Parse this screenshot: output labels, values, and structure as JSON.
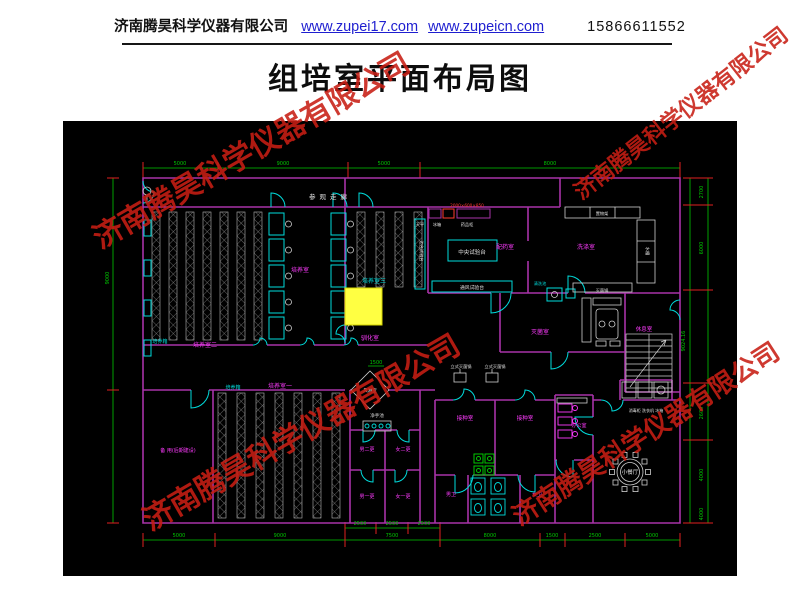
{
  "header": {
    "company": "济南腾昊科学仪器有限公司",
    "link1": "www.zupei17.com",
    "link2": "www.zupeicn.com",
    "phone": "15866611552"
  },
  "title": "组培室平面布局图",
  "watermark": {
    "text": "济南腾昊科学仪器有限公司",
    "color": "#c81e14",
    "instances": [
      {
        "x": 70,
        "y": 126,
        "size": 30,
        "rotate": -30
      },
      {
        "x": 548,
        "y": 96,
        "size": 22,
        "rotate": -38
      },
      {
        "x": 120,
        "y": 408,
        "size": 30,
        "rotate": -30
      },
      {
        "x": 489,
        "y": 414,
        "size": 26,
        "rotate": -33
      }
    ]
  },
  "plan": {
    "colors": {
      "background": "#000000",
      "wall": "#a833a8",
      "label_magenta": "#ff3bff",
      "cyan": "#00dcdc",
      "dim_green": "#00c800",
      "tick_red": "#e02020",
      "white": "#e0e0e0",
      "rack": "#b5b5b5",
      "highlight_yellow": "#ffff42",
      "bench_red": "#ff3b30",
      "green_fixture": "#00c800"
    },
    "room_labels": [
      {
        "t": "参观走廊",
        "x": 267,
        "y": 78,
        "c": "#e0e0e0",
        "s": 6.5,
        "sp": 4
      },
      {
        "t": "培养室",
        "x": 237,
        "y": 151,
        "c": "#ff3bff",
        "s": 6
      },
      {
        "t": "培养室二",
        "x": 142,
        "y": 226,
        "c": "#ff3bff",
        "s": 6
      },
      {
        "t": "培养箱",
        "x": 97,
        "y": 222,
        "c": "#00dcdc",
        "s": 5
      },
      {
        "t": "培养室三",
        "x": 311,
        "y": 162,
        "c": "#00dcdc",
        "s": 6
      },
      {
        "t": "驯化室",
        "x": 307,
        "y": 219,
        "c": "#ff3bff",
        "s": 6
      },
      {
        "t": "培养室一",
        "x": 217,
        "y": 267,
        "c": "#ff3bff",
        "s": 6
      },
      {
        "t": "培养箱",
        "x": 170,
        "y": 268,
        "c": "#00dcdc",
        "s": 5
      },
      {
        "t": "备 用(后期建设)",
        "x": 115,
        "y": 331,
        "c": "#ff3bff",
        "s": 5
      },
      {
        "t": "配药室",
        "x": 442,
        "y": 128,
        "c": "#ff3bff",
        "s": 6
      },
      {
        "t": "洗涤室",
        "x": 523,
        "y": 128,
        "c": "#ff3bff",
        "s": 6
      },
      {
        "t": "灭菌室",
        "x": 477,
        "y": 213,
        "c": "#ff3bff",
        "s": 6
      },
      {
        "t": "休息室",
        "x": 581,
        "y": 210,
        "c": "#ff3bff",
        "s": 5.5
      },
      {
        "t": "办公室",
        "x": 516,
        "y": 306,
        "c": "#ff3bff",
        "s": 5
      },
      {
        "t": "接种室",
        "x": 402,
        "y": 299,
        "c": "#ff3bff",
        "s": 5.5
      },
      {
        "t": "接种室",
        "x": 462,
        "y": 299,
        "c": "#ff3bff",
        "s": 5.5
      },
      {
        "t": "男二更",
        "x": 304,
        "y": 330,
        "c": "#ff3bff",
        "s": 5
      },
      {
        "t": "女二更",
        "x": 340,
        "y": 330,
        "c": "#ff3bff",
        "s": 5
      },
      {
        "t": "男一更",
        "x": 304,
        "y": 377,
        "c": "#ff3bff",
        "s": 5
      },
      {
        "t": "女一更",
        "x": 340,
        "y": 377,
        "c": "#ff3bff",
        "s": 5
      },
      {
        "t": "男卫",
        "x": 388,
        "y": 375,
        "c": "#ff3bff",
        "s": 5
      },
      {
        "t": "女卫",
        "x": 474,
        "y": 375,
        "c": "#ff3bff",
        "s": 5
      },
      {
        "t": "小餐厅",
        "x": 567,
        "y": 353,
        "c": "#e0e0e0",
        "s": 5.5
      },
      {
        "t": "风淋室",
        "x": 307,
        "y": 271,
        "c": "#e0e0e0",
        "s": 4.5
      },
      {
        "t": "净手池",
        "x": 314,
        "y": 296,
        "c": "#e0e0e0",
        "s": 4.5
      },
      {
        "t": "中央试验台",
        "x": 409,
        "y": 133,
        "c": "#e0e0e0",
        "s": 5.5
      },
      {
        "t": "通风试验台",
        "x": 409,
        "y": 168,
        "c": "#e0e0e0",
        "s": 4.8
      },
      {
        "t": "天平",
        "x": 357,
        "y": 105,
        "c": "#e0e0e0",
        "s": 4.2
      },
      {
        "t": "冰箱",
        "x": 374,
        "y": 105,
        "c": "#e0e0e0",
        "s": 4.2
      },
      {
        "t": "药品柜",
        "x": 404,
        "y": 105,
        "c": "#e0e0e0",
        "s": 4.2
      },
      {
        "t": "置物架",
        "x": 539,
        "y": 94,
        "c": "#e0e0e0",
        "s": 4.2
      },
      {
        "t": "水槽",
        "x": 583,
        "y": 130,
        "c": "#e0e0e0",
        "s": 4.2,
        "r": 90
      },
      {
        "t": "灭菌锅",
        "x": 539,
        "y": 171,
        "c": "#e0e0e0",
        "s": 4.2
      },
      {
        "t": "清洗池",
        "x": 477,
        "y": 164,
        "c": "#00dcdc",
        "s": 4.2
      },
      {
        "t": "立式灭菌锅",
        "x": 398,
        "y": 247,
        "c": "#e0e0e0",
        "s": 4.2
      },
      {
        "t": "立式灭菌锅",
        "x": 432,
        "y": 247,
        "c": "#e0e0e0",
        "s": 4.2
      },
      {
        "t": "消毒柜 洗衣机 冰箱",
        "x": 583,
        "y": 291,
        "c": "#e0e0e0",
        "s": 4
      },
      {
        "t": "边台试验台",
        "x": 357,
        "y": 130,
        "c": "#e0e0e0",
        "s": 4.2,
        "r": 90
      },
      {
        "t": "2000×600×850",
        "x": 404,
        "y": 86,
        "c": "#ff3b30",
        "s": 4.2
      }
    ],
    "dim_labels": [
      {
        "t": "5000",
        "x": 117,
        "y": 44
      },
      {
        "t": "9000",
        "x": 220,
        "y": 44
      },
      {
        "t": "5000",
        "x": 321,
        "y": 44
      },
      {
        "t": "8000",
        "x": 487,
        "y": 44
      },
      {
        "t": "5000",
        "x": 116,
        "y": 416
      },
      {
        "t": "9000",
        "x": 217,
        "y": 416
      },
      {
        "t": "7500",
        "x": 329,
        "y": 416
      },
      {
        "t": "8000",
        "x": 427,
        "y": 416
      },
      {
        "t": "1500",
        "x": 489,
        "y": 416
      },
      {
        "t": "2500",
        "x": 532,
        "y": 416
      },
      {
        "t": "5000",
        "x": 589,
        "y": 416
      },
      {
        "t": "2500",
        "x": 297,
        "y": 404
      },
      {
        "t": "2500",
        "x": 329,
        "y": 404
      },
      {
        "t": "2500",
        "x": 361,
        "y": 404
      },
      {
        "t": "9000",
        "x": 46,
        "y": 157,
        "r": -90
      },
      {
        "t": "9024.16",
        "x": 622,
        "y": 220,
        "r": -90
      },
      {
        "t": "2700",
        "x": 640,
        "y": 71,
        "r": -90
      },
      {
        "t": "6000",
        "x": 640,
        "y": 127,
        "r": -90
      },
      {
        "t": "2600",
        "x": 640,
        "y": 292,
        "r": -90
      },
      {
        "t": "4000",
        "x": 640,
        "y": 354,
        "r": -90
      },
      {
        "t": "4000",
        "x": 640,
        "y": 393,
        "r": -90
      },
      {
        "t": "1500",
        "x": 313,
        "y": 243
      }
    ]
  }
}
